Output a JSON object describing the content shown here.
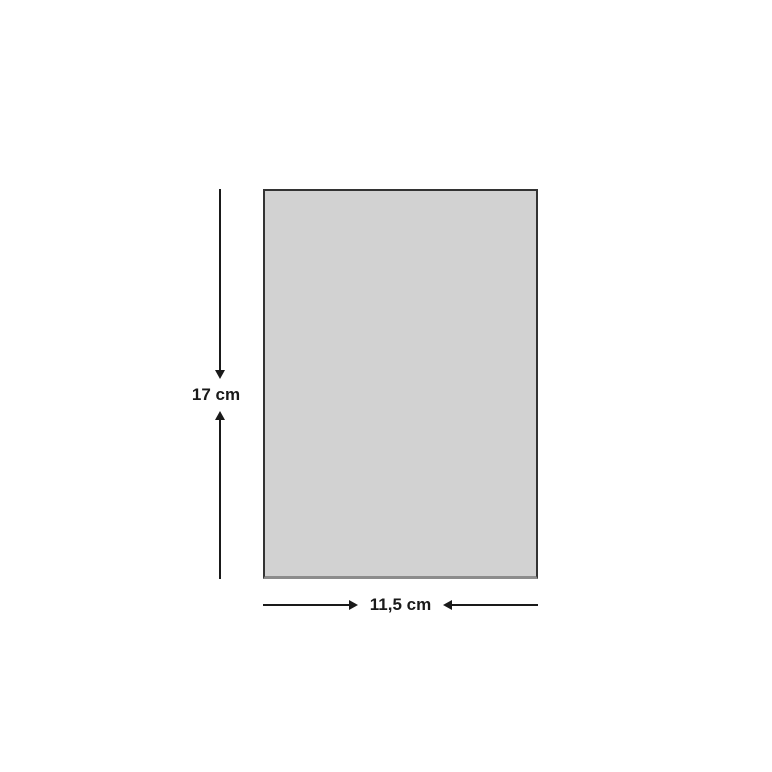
{
  "diagram": {
    "height_label": "17 cm",
    "width_label": "11,5 cm"
  },
  "icons": {
    "arrow_down": "css-triangle-down",
    "arrow_up": "css-triangle-up",
    "arrow_right": "css-triangle-right",
    "arrow_left": "css-triangle-left"
  },
  "colors": {
    "background": "#ffffff",
    "rect_fill": "#d2d2d2",
    "rect_border": "#333333",
    "rect_border_bottom": "#8c8c8c",
    "line": "#1a1a1a",
    "text": "#1a1a1a"
  }
}
